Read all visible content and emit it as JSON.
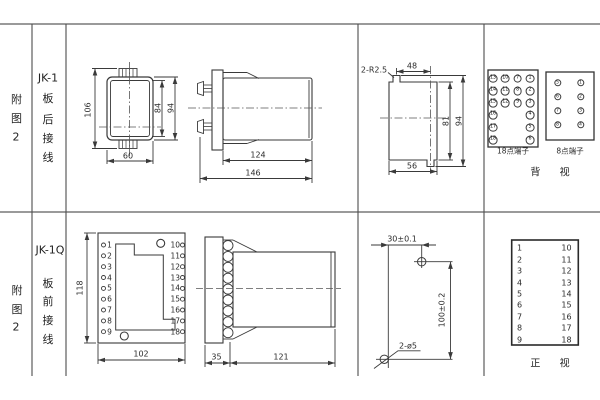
{
  "rows": [
    {
      "fig_label": [
        "附",
        "图",
        "2"
      ],
      "model": "JK-1",
      "wiring_label": [
        "板",
        "后",
        "接",
        "线"
      ],
      "front_view": {
        "dim_total_height": "106",
        "dim_inner_height": "84",
        "dim_outer_height": "94",
        "dim_width": "60"
      },
      "side_view": {
        "dim_body_depth": "124",
        "dim_total_depth": "146"
      },
      "panel_cutout": {
        "corner_note": "2-R2.5",
        "dim_top_width": "48",
        "dim_inner_height": "81",
        "dim_outer_height": "94",
        "dim_bottom_width": "56"
      },
      "rear_terminals": {
        "block18": {
          "label": "18点端子",
          "grid": [
            [
              "13",
              "10",
              "7",
              "1"
            ],
            [
              "14",
              "11",
              "8",
              "2"
            ],
            [
              "15",
              "12",
              "9",
              "3"
            ],
            [
              "16",
              "4"
            ],
            [
              "17",
              "5"
            ],
            [
              "18",
              "6"
            ]
          ]
        },
        "block8": {
          "label": "8点端子",
          "grid": [
            [
              "5",
              "1"
            ],
            [
              "6",
              "2"
            ],
            [
              "7",
              "3"
            ],
            [
              "8",
              "4"
            ]
          ]
        },
        "view_label": "背 视"
      }
    },
    {
      "fig_label": [
        "附",
        "图",
        "2"
      ],
      "model": "JK-1Q",
      "wiring_label": [
        "板",
        "前",
        "接",
        "线"
      ],
      "front_view": {
        "left_terminals": [
          "1",
          "2",
          "3",
          "4",
          "5",
          "6",
          "7",
          "8",
          "9"
        ],
        "right_terminals": [
          "10",
          "11",
          "12",
          "13",
          "14",
          "15",
          "16",
          "17",
          "18"
        ],
        "dim_height": "118",
        "dim_width": "102"
      },
      "side_view": {
        "dim_front_depth": "35",
        "dim_body_depth": "121"
      },
      "drill_plan": {
        "dim_horizontal": "30±0.1",
        "dim_vertical": "100±0.2",
        "hole_note": "2-ø5"
      },
      "terminal_table": {
        "left": [
          "1",
          "2",
          "3",
          "4",
          "5",
          "6",
          "7",
          "8",
          "9"
        ],
        "right": [
          "10",
          "11",
          "12",
          "13",
          "14",
          "15",
          "16",
          "17",
          "18"
        ],
        "view_label": "正 视"
      }
    }
  ]
}
